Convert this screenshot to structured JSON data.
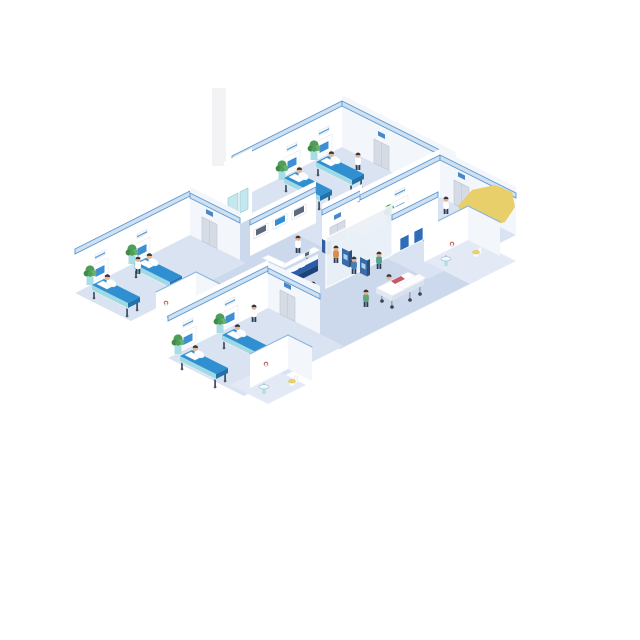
{
  "image_type": "isometric-vector-illustration",
  "subject": "hospital ward interior with patient rooms, reception and lobby",
  "colors": {
    "background": "#ffffff",
    "floor_hall": "#ccd8eb",
    "floor_room": "#d9e3f2",
    "floor_bath": "#e3eaf5",
    "wall": "#ffffff",
    "wall_shade": "#f3f6fb",
    "stripe_band": "#cfe0f1",
    "stripe_line": "#5b97d0",
    "partition_edge": "#8ab4de",
    "bed_top": "#2f8fd0",
    "bed_dark": "#2273a8",
    "bed_side": "#9fd9e3",
    "bed_frame": "#e8edf4",
    "bed_leg": "#4a5565",
    "pillow": "#ffffff",
    "patient_gown": "#fbfdff",
    "plant_dark": "#3f8a49",
    "plant_mid": "#4f9e57",
    "plant_light": "#68b271",
    "pedestal": "#a8dde6",
    "pedestal_top": "#d6f1f5",
    "desk_blue": "#2a5ca8",
    "desk_navy": "#1c4379",
    "desk_white": "#f7fafc",
    "glass": "#ebf1f8",
    "kiosk_front": "#3b6ba6",
    "kiosk_side": "#2c4f7d",
    "kiosk_screen": "#a9d3f0",
    "door": "#d6dce6",
    "door_frame": "#c2cad8",
    "door_sign": "#4b86c8",
    "poster": "#2f6db8",
    "monitor_frame": "#ffffff",
    "monitor_screen": "#5b6b7d",
    "monitor_active": "#2f8fd4",
    "headwall_screen": "#3f8fd4",
    "sink_body": "#b5dce8",
    "sink_basin": "#f4fafc",
    "toilet_body": "#f7fafc",
    "toilet_seat": "#f0d264",
    "accent_red": "#c03a30",
    "skin": "#e9b38c",
    "hair": "#35353f",
    "legs": "#2e3d57",
    "coat_white": "#ffffff",
    "scrub_green": "#4fa28c",
    "nurse_green": "#5fa57b",
    "civilian_orange": "#e08a4a",
    "civilian_blue": "#4a7fb5",
    "civilian_navy": "#2f4a6e",
    "civilian_teal": "#4f9aa8",
    "patient_pink": "#c65b6a",
    "gurney_white": "#ffffff",
    "highlight_yellow": "#e9cf6a",
    "column_faint": "#f3f3f5"
  },
  "rooms": [
    {
      "name": "ward-room-top",
      "beds": 2,
      "patients": 2,
      "staff": [
        "nurse"
      ],
      "plants": 2,
      "headwall_panels": 2,
      "doors": 1
    },
    {
      "name": "ward-room-right",
      "beds": 1,
      "patients": 1,
      "staff": [
        "doctor"
      ],
      "plants": 1,
      "headwall_panels": 1,
      "doors": 1
    },
    {
      "name": "ward-room-left",
      "beds": 2,
      "patients": 2,
      "staff": [
        "nurse"
      ],
      "plants": 2,
      "headwall_panels": 2,
      "doors": 1
    },
    {
      "name": "ward-room-bottom",
      "beds": 2,
      "patients": 2,
      "staff": [
        "nurse"
      ],
      "plants": 2,
      "headwall_panels": 2,
      "doors": 1
    }
  ],
  "lobby": {
    "reception_desk": {
      "front_band_color": "#2a5ca8",
      "sign_text_legible": false,
      "staff": [
        "receptionist"
      ],
      "equipment": [
        "computer"
      ]
    },
    "wall_monitors": 3,
    "self_service_kiosks": 2,
    "kiosk_users": 2,
    "walking_visitors": 2,
    "walking_nurse": 1,
    "gurney": {
      "patient": 1,
      "attendant": "doctor-in-scrubs"
    },
    "medicine_cabinet": 1
  },
  "bathrooms": [
    {
      "name": "bathroom-mid",
      "fixtures": [
        "sink",
        "towel-ring"
      ]
    },
    {
      "name": "bathroom-right",
      "fixtures": [
        "sink",
        "toilet",
        "towel-ring"
      ]
    },
    {
      "name": "bathroom-left",
      "fixtures": [
        "sink",
        "towel-ring"
      ]
    },
    {
      "name": "bathroom-bottom",
      "fixtures": [
        "sink",
        "toilet",
        "towel-ring"
      ]
    }
  ],
  "highlight_shape": {
    "type": "polygon",
    "color": "#e9cf6a",
    "location": "right-of-right-room"
  }
}
